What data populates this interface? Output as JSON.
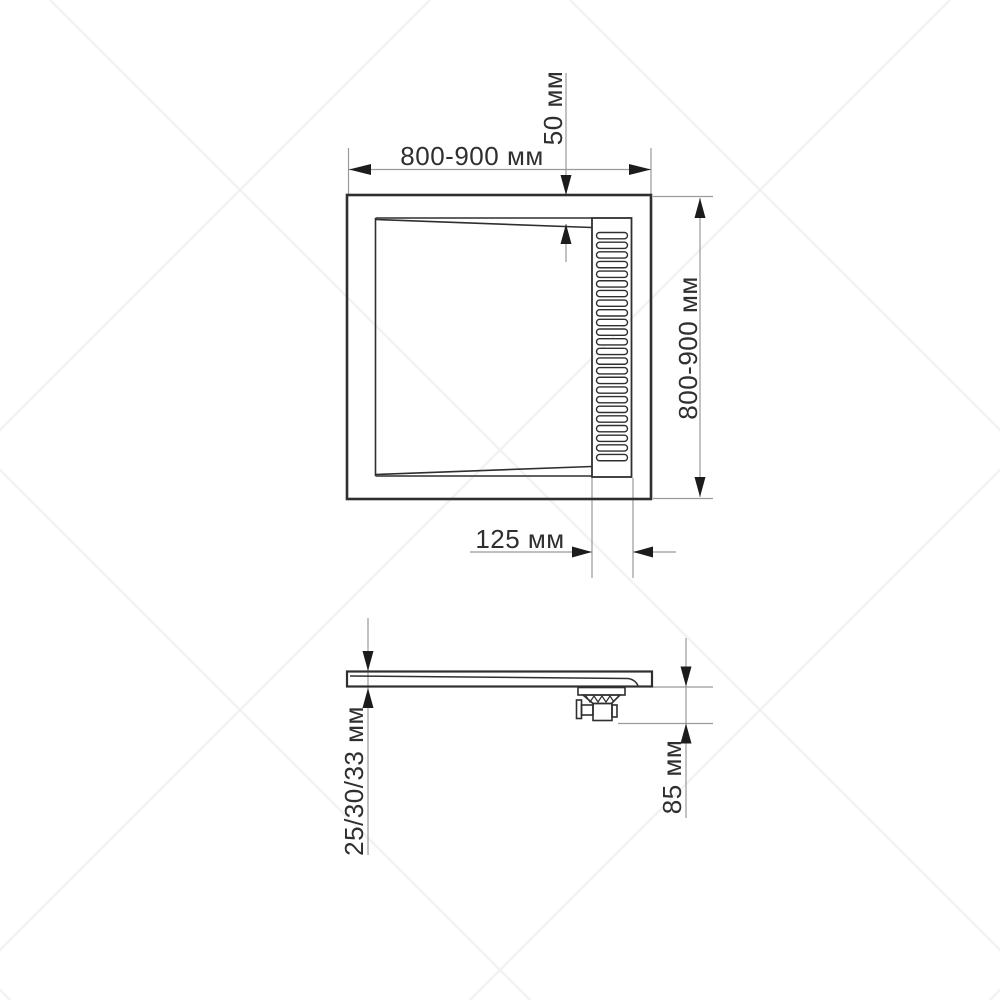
{
  "drawing": {
    "type": "technical dimensional drawing of a square shower tray with linear drain",
    "plan_view": {
      "width_dimension_label": "800-900 мм",
      "height_dimension_label": "800-900 мм",
      "grate_offset_dimension_label": "50 мм",
      "grate_width_dimension_label": "125 мм",
      "grate": {
        "slat_count": 24
      }
    },
    "side_view": {
      "thickness_dimension_label": "25/30/33 мм",
      "trap_height_dimension_label": "85 мм"
    },
    "colors": {
      "object_line": "#2f2f2f",
      "dimension_line": "#9a9a9a",
      "arrow": "#1c1c1c",
      "label_text": "#2f2f2f",
      "background": "#ffffff",
      "watermark_line": "#f2f2f2"
    }
  }
}
